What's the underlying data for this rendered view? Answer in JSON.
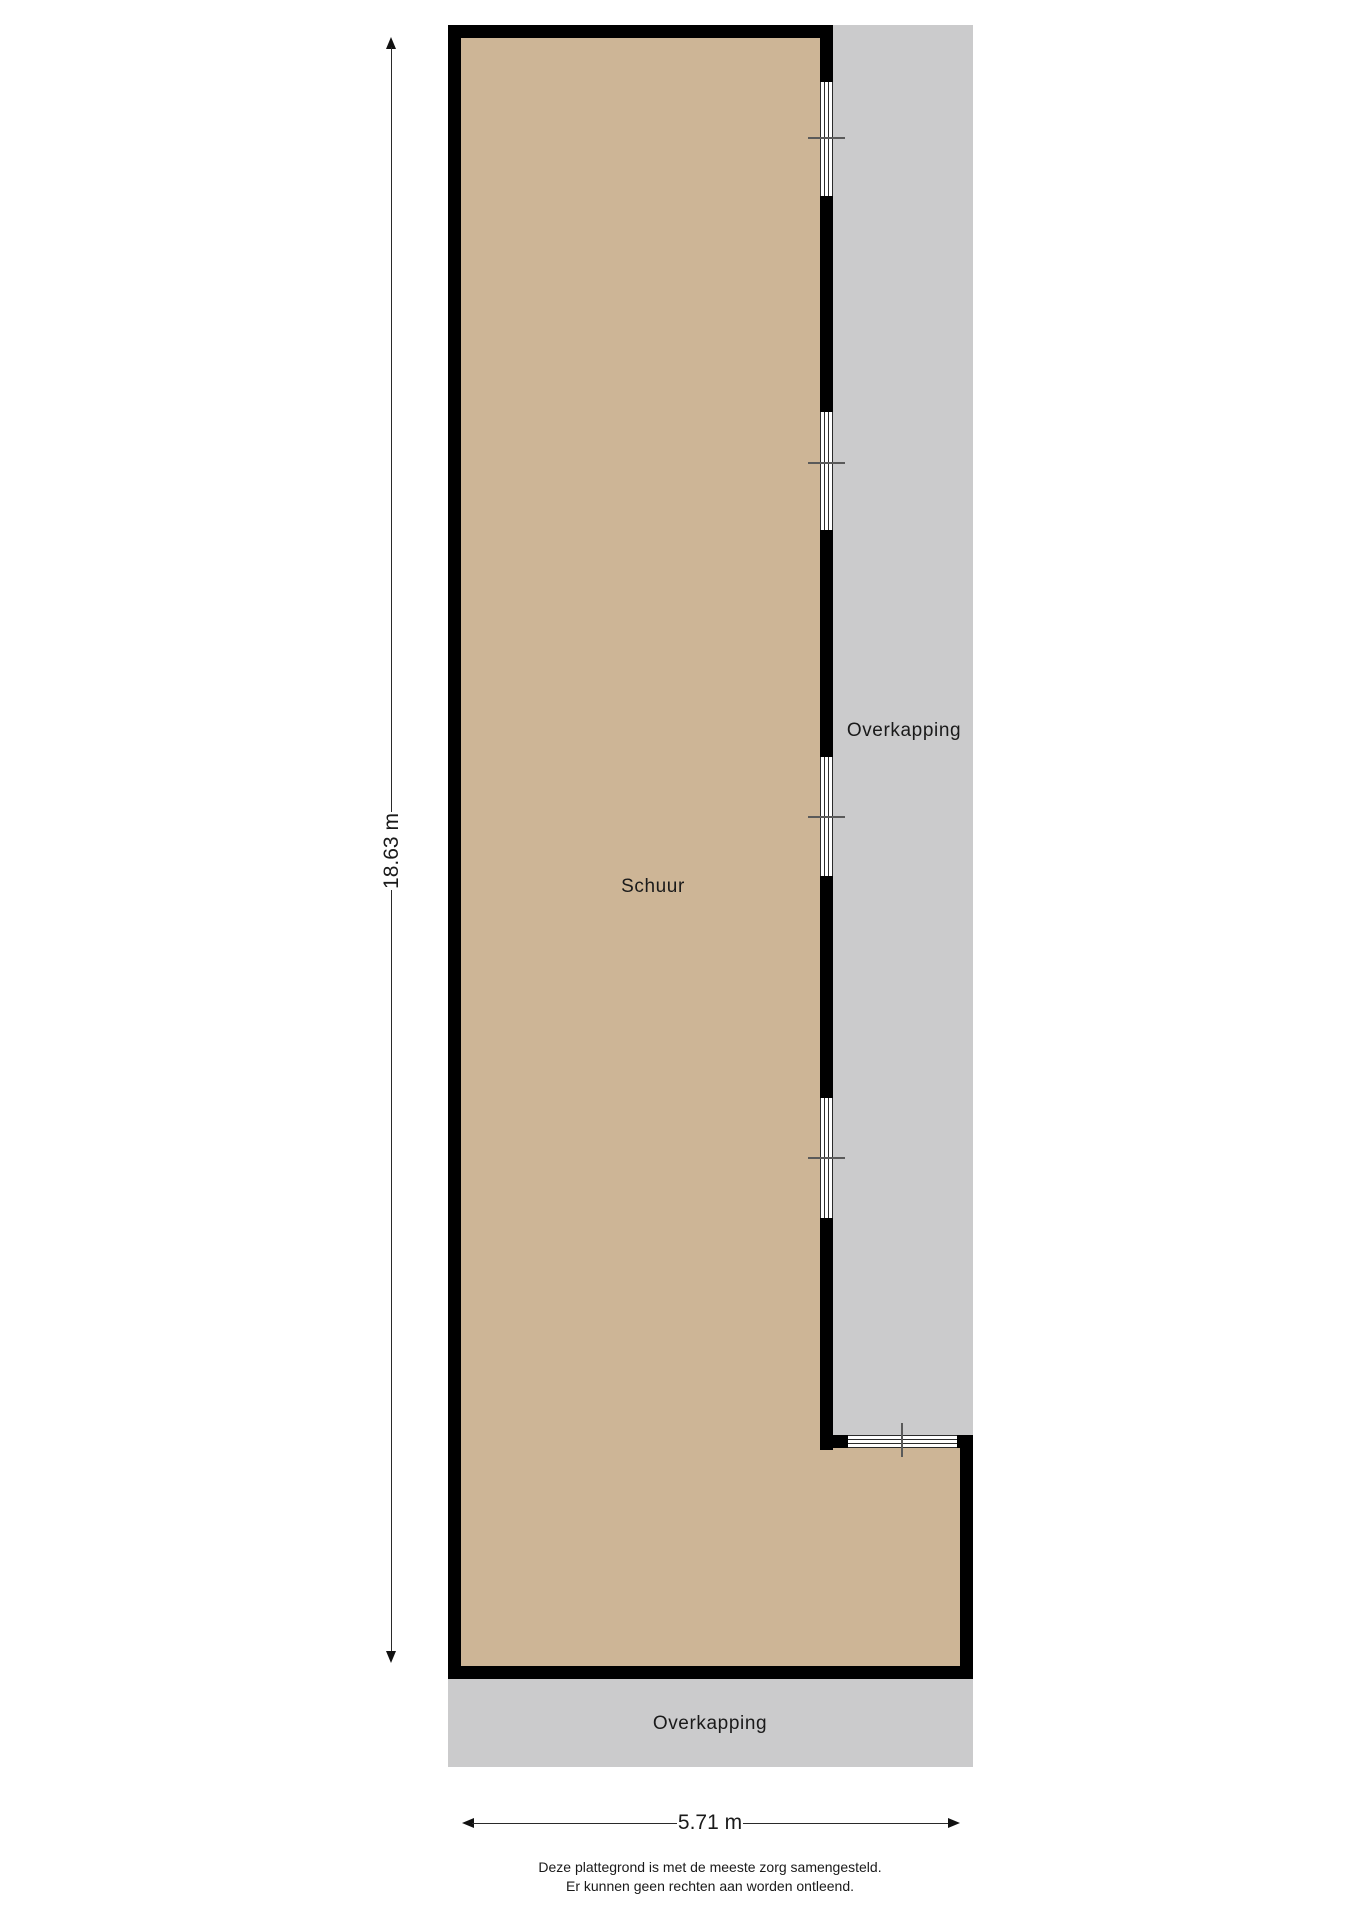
{
  "plan": {
    "title": "Schuur plattegrond",
    "rooms": [
      {
        "label": "Schuur"
      }
    ],
    "areas": [
      {
        "label": "Overkapping",
        "position": "right"
      },
      {
        "label": "Overkapping",
        "position": "bottom"
      }
    ],
    "dimensions": {
      "height_label": "18.63 m",
      "width_label": "5.71 m"
    },
    "disclaimer": {
      "line1": "Deze plattegrond is met de meeste zorg samengesteld.",
      "line2": "Er kunnen geen rechten aan worden ontleend."
    },
    "colors": {
      "floor": "#cdb596",
      "canopy": "#cbcbcc",
      "wall": "#000000",
      "background": "#ffffff",
      "dimension_line": "#2a2a2a",
      "window_tick": "#5a5a5a"
    }
  }
}
